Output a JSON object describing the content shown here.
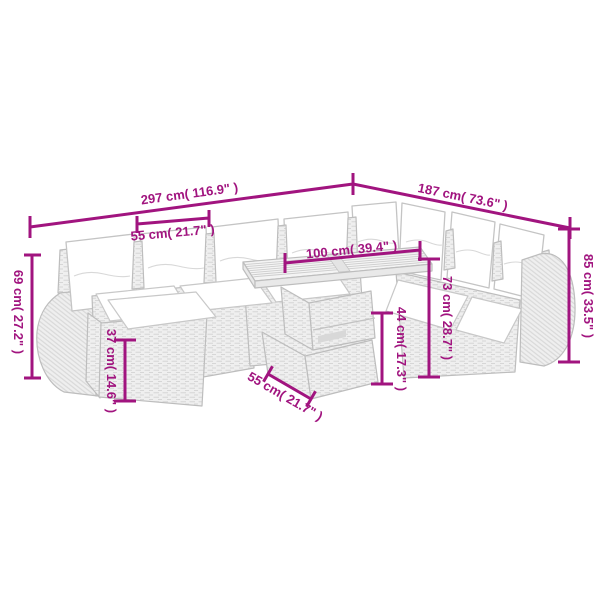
{
  "diagram": {
    "product": "rattan garden lounge set with cushions, ottoman and slatted-top table",
    "style": {
      "accent_color": "#A1147F",
      "furniture_line_color": "#bdbdbd",
      "rattan_fill": "#efefef",
      "cushion_color": "#ffffff",
      "background": "#ffffff"
    },
    "measurements": {
      "total_width": "297 cm( 116.9\" )",
      "total_depth": "187 cm( 73.6\" )",
      "seat_width": "55 cm( 21.7\" )",
      "tabletop_length": "100 cm( 39.4\" )",
      "backrest_height": "69 cm( 27.2\" )",
      "ottoman_height": "37 cm( 14.6\" )",
      "tabletop_depth": "55 cm( 21.7\" )",
      "table_clearance_height": "44 cm( 17.3\" )",
      "table_height": "73 cm( 28.7\" )",
      "total_height": "85 cm( 33.5\" )"
    }
  }
}
